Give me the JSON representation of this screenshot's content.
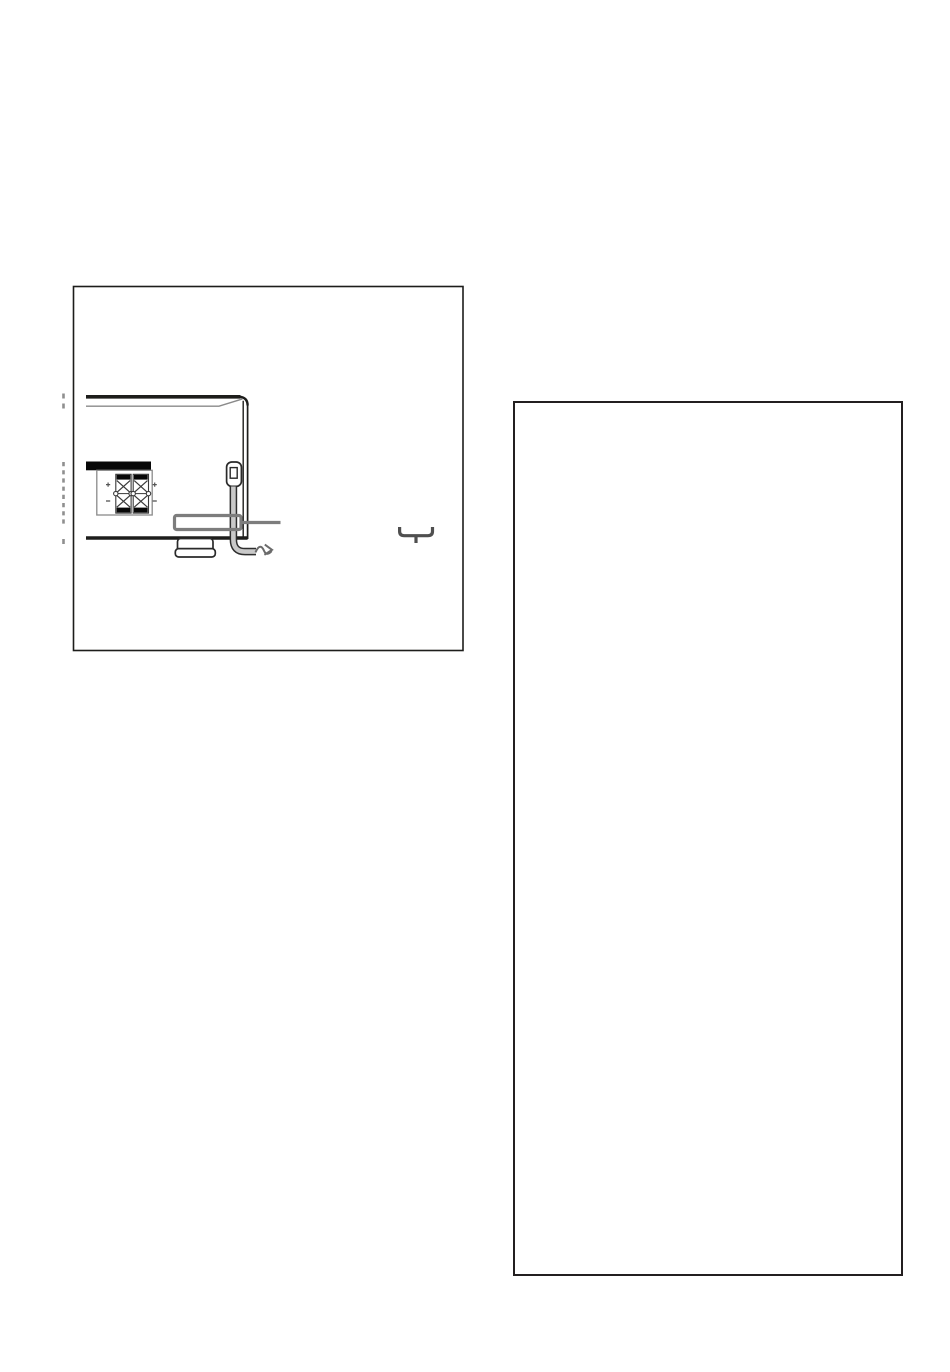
{
  "page": {
    "background": "#ffffff"
  },
  "colors": {
    "ink": "#1d1d1b",
    "soft": "#8f8f8f",
    "bevel": "#8a8a8a",
    "highlight": "#7d7d7d",
    "cord_outline": "#2e2e2e",
    "cord_fill": "#c9c9c9",
    "arrow": "#6b6b6b",
    "brace": "#4f4f4f",
    "terminal_ink": "#080808",
    "note_border": "#231f20"
  },
  "icons": [
    "receiver-rear-corner-icon",
    "speaker-terminal-block-icon",
    "terminal-plus-mark-icon",
    "terminal-minus-mark-icon",
    "power-cord-strain-relief-icon",
    "ac-power-cord-icon",
    "cord-highlight-callout-icon",
    "callout-leader-line-icon",
    "to-outlet-arrow-icon",
    "underbrace-icon",
    "illustration-break-marks-icon"
  ]
}
